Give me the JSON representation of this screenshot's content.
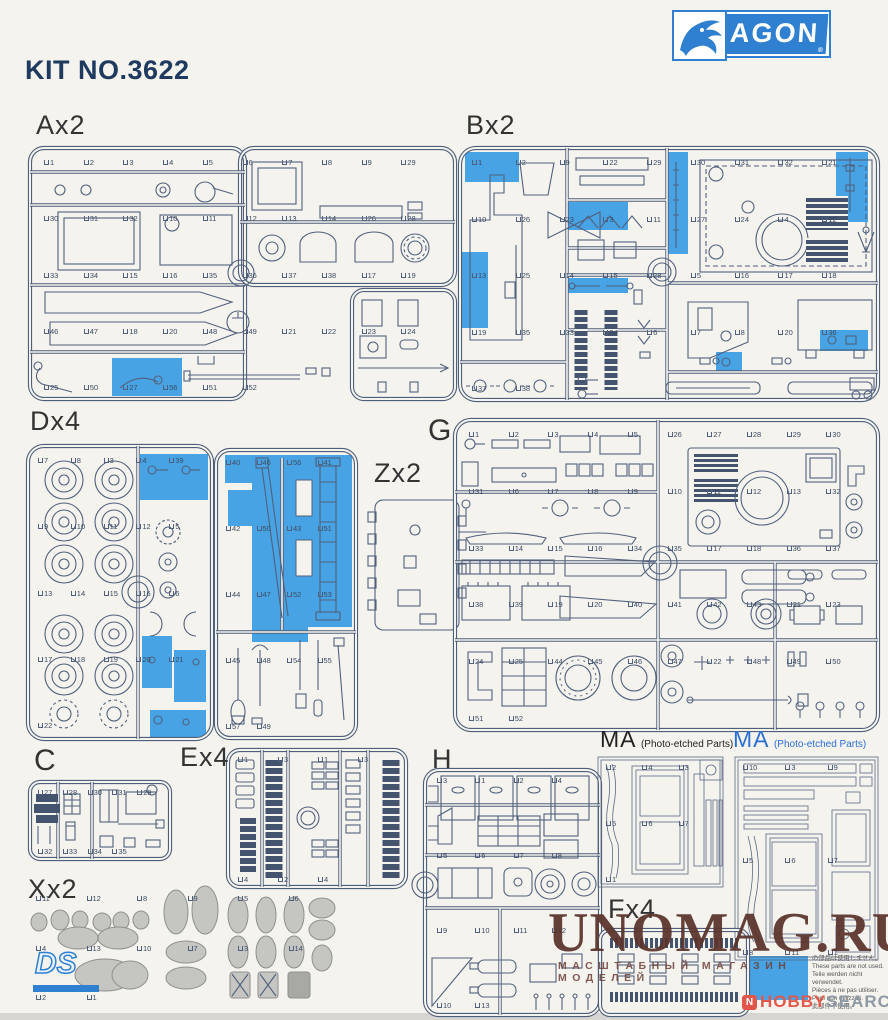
{
  "header": {
    "kit_no": "KIT NO.3622"
  },
  "brand": {
    "name": "DRAGON",
    "registered": "®"
  },
  "sprues": {
    "a": {
      "label": "Ax2",
      "parts": [
        "1",
        "2",
        "3",
        "4",
        "5",
        "6",
        "7",
        "8",
        "9",
        "29",
        "30",
        "31",
        "32",
        "10",
        "11",
        "12",
        "13",
        "14",
        "26",
        "28",
        "33",
        "34",
        "15",
        "16",
        "35",
        "36",
        "37",
        "38",
        "17",
        "19",
        "46",
        "47",
        "18",
        "20",
        "48",
        "49",
        "21",
        "22",
        "23",
        "24",
        "25",
        "50",
        "27",
        "56",
        "51",
        "52"
      ]
    },
    "b": {
      "label": "Bx2",
      "parts": [
        "1",
        "2",
        "9",
        "22",
        "29",
        "30",
        "31",
        "32",
        "21",
        "10",
        "26",
        "23",
        "3",
        "11",
        "27",
        "24",
        "4",
        "12",
        "13",
        "25",
        "14",
        "15",
        "28",
        "5",
        "16",
        "17",
        "18",
        "19",
        "35",
        "33",
        "34",
        "6",
        "7",
        "8",
        "20",
        "36",
        "37",
        "38"
      ]
    },
    "d": {
      "label": "Dx4",
      "parts_left": [
        "7",
        "8",
        "3",
        "4",
        "39",
        "9",
        "10",
        "11",
        "12",
        "5",
        "13",
        "14",
        "15",
        "16",
        "6",
        "17",
        "18",
        "19",
        "20",
        "21",
        "22"
      ],
      "parts_right": [
        "40",
        "46",
        "56",
        "41",
        "42",
        "50",
        "43",
        "51",
        "44",
        "47",
        "52",
        "53",
        "45",
        "48",
        "54",
        "55",
        "57",
        "49"
      ]
    },
    "z": {
      "label": "Zx2"
    },
    "g": {
      "label": "G",
      "parts": [
        "1",
        "2",
        "3",
        "4",
        "5",
        "26",
        "27",
        "28",
        "29",
        "30",
        "31",
        "6",
        "7",
        "8",
        "9",
        "10",
        "11",
        "12",
        "13",
        "32",
        "33",
        "14",
        "15",
        "16",
        "34",
        "35",
        "17",
        "18",
        "36",
        "37",
        "38",
        "39",
        "19",
        "20",
        "40",
        "41",
        "42",
        "43",
        "21",
        "23",
        "24",
        "25",
        "44",
        "45",
        "46",
        "47",
        "22",
        "48",
        "49",
        "50",
        "51",
        "52"
      ]
    },
    "c": {
      "label": "C",
      "parts": [
        "27",
        "28",
        "30",
        "31",
        "29",
        "32",
        "33",
        "34",
        "35"
      ]
    },
    "e": {
      "label": "Ex4",
      "parts": [
        "1",
        "3",
        "1",
        "3",
        "4",
        "2",
        "4"
      ]
    },
    "x": {
      "label": "Xx2",
      "ds_logo": "DS",
      "parts": [
        "11",
        "12",
        "8",
        "9",
        "5",
        "6",
        "4",
        "13",
        "10",
        "7",
        "3",
        "14",
        "2",
        "1"
      ]
    },
    "h": {
      "label": "H",
      "parts": [
        "3",
        "1",
        "2",
        "4",
        "5",
        "6",
        "7",
        "8",
        "9",
        "10",
        "11",
        "12",
        "10",
        "13"
      ]
    },
    "ma_black": {
      "label": "MA",
      "subtitle": "(Photo-etched Parts)",
      "parts": [
        "2",
        "4",
        "3",
        "5",
        "6",
        "7",
        "1"
      ]
    },
    "ma_blue": {
      "label": "MA",
      "subtitle": "(Photo-etched Parts)",
      "parts": [
        "10",
        "3",
        "9",
        "5",
        "6",
        "7",
        "8",
        "11",
        "1"
      ]
    },
    "f": {
      "label": "Fx4"
    }
  },
  "legend": {
    "lines": [
      "の部品は使用しません。",
      "These parts are not used.",
      "Teile werden nicht verwendet.",
      "Pièces à ne pas utiliser.",
      "Parti non utilizzati.",
      "此部件不使用。"
    ]
  },
  "watermark": {
    "title": "UNOMAG.RU",
    "subtitle": "МАСШТАБНЫЙ МАГАЗИН МОДЕЛЕЙ"
  },
  "footer": {
    "hobby": "HOBBY",
    "search": "SEARCH"
  },
  "colors": {
    "highlight": "#47a3e3",
    "line": "#4e5f7b",
    "brand_blue": "#2f80d0",
    "watermark": "#5a332c"
  }
}
